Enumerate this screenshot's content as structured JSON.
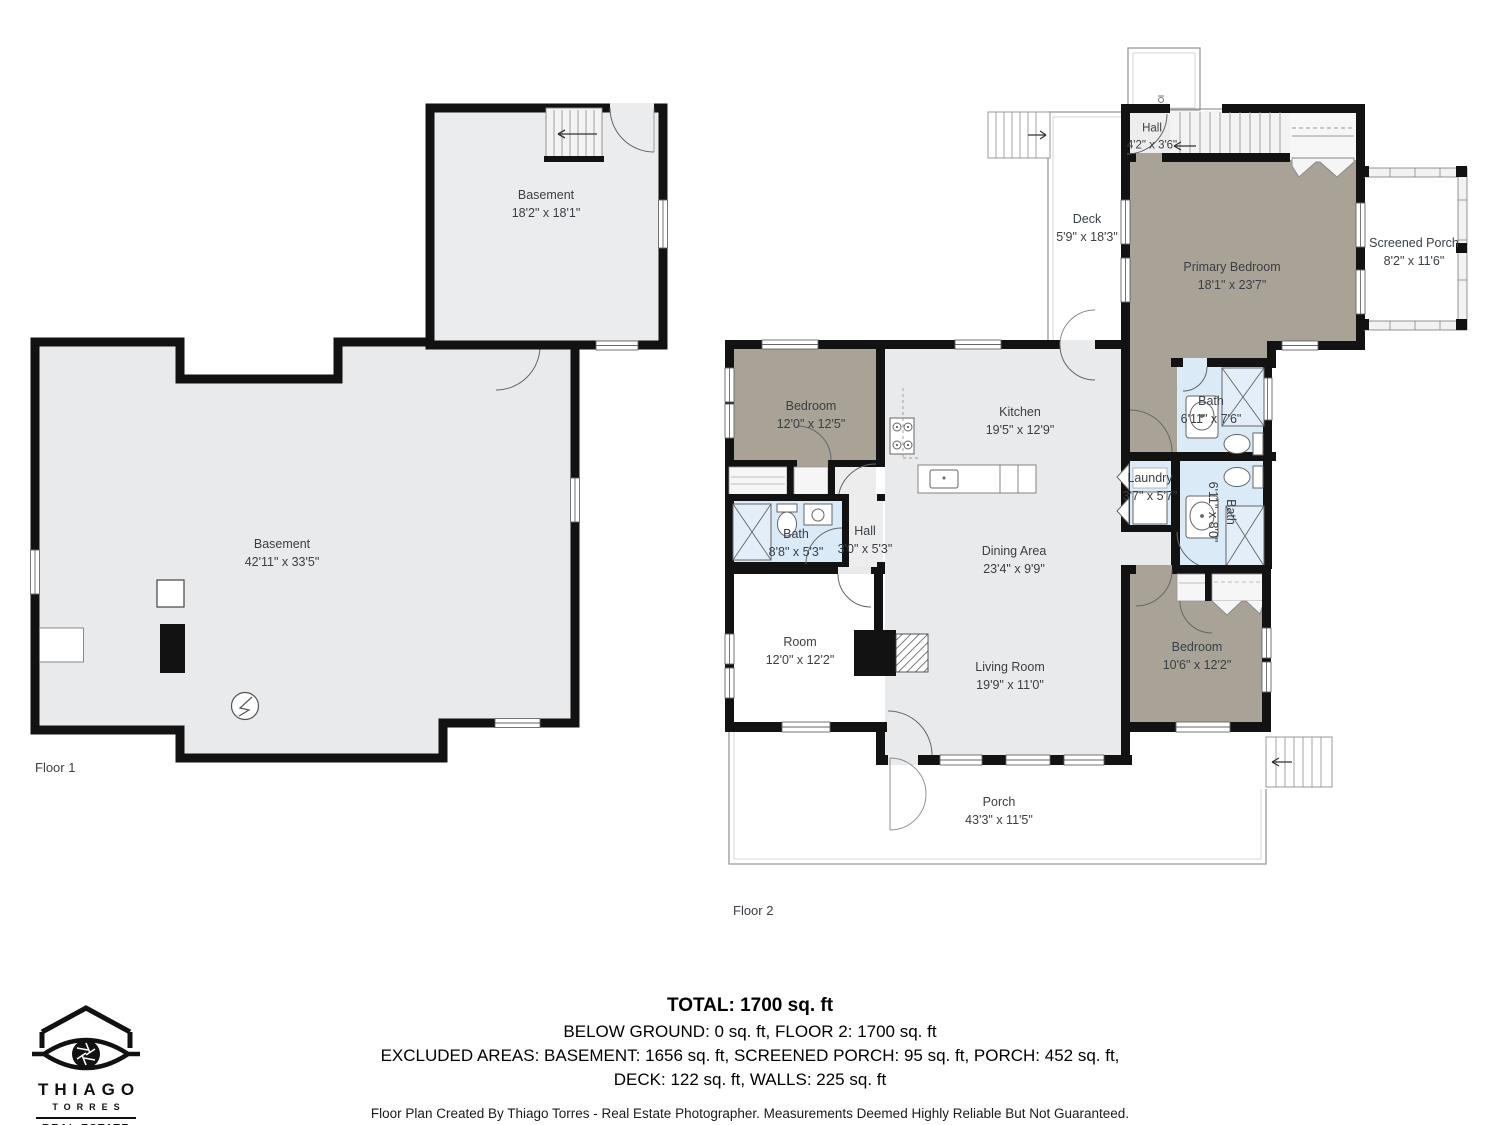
{
  "floor1": {
    "caption": "Floor 1",
    "rooms": {
      "basement_upper": {
        "name": "Basement",
        "dims": "18'2\" x 18'1\""
      },
      "basement_main": {
        "name": "Basement",
        "dims": "42'11\" x 33'5\""
      }
    }
  },
  "floor2": {
    "caption": "Floor 2",
    "rooms": {
      "hall_top": {
        "name": "Hall",
        "dims": "4'2\" x 3'6\""
      },
      "deck": {
        "name": "Deck",
        "dims": "5'9\" x 18'3\""
      },
      "primary_bedroom": {
        "name": "Primary Bedroom",
        "dims": "18'1\" x 23'7\""
      },
      "screened_porch": {
        "name": "Screened Porch",
        "dims": "8'2\" x 11'6\""
      },
      "bedroom_upper": {
        "name": "Bedroom",
        "dims": "12'0\" x 12'5\""
      },
      "kitchen": {
        "name": "Kitchen",
        "dims": "19'5\" x 12'9\""
      },
      "bath_main": {
        "name": "Bath",
        "dims": "8'8\" x 5'3\""
      },
      "hall_main": {
        "name": "Hall",
        "dims": "3'0\" x 5'3\""
      },
      "dining": {
        "name": "Dining Area",
        "dims": "23'4\" x 9'9\""
      },
      "room": {
        "name": "Room",
        "dims": "12'0\" x 12'2\""
      },
      "living": {
        "name": "Living Room",
        "dims": "19'9\" x 11'0\""
      },
      "laundry": {
        "name": "Laundry",
        "dims": "3'7\" x 5'7\""
      },
      "bath_upper": {
        "name": "Bath",
        "dims": "6'11\" x 7'6\""
      },
      "bath_lower": {
        "name": "Bath",
        "dims": "6'11\" x 8'0\""
      },
      "bedroom_lower": {
        "name": "Bedroom",
        "dims": "10'6\" x 12'2\""
      },
      "porch": {
        "name": "Porch",
        "dims": "43'3\" x 11'5\""
      }
    }
  },
  "summary": {
    "total": "TOTAL: 1700 sq. ft",
    "line2": "BELOW GROUND: 0 sq. ft, FLOOR 2: 1700 sq. ft",
    "line3": "EXCLUDED AREAS: BASEMENT: 1656 sq. ft, SCREENED PORCH: 95 sq. ft, PORCH: 452 sq. ft,",
    "line4": "DECK: 122 sq. ft, WALLS: 225 sq. ft",
    "disclaimer": "Floor Plan Created By Thiago Torres - Real Estate Photographer. Measurements Deemed Highly Reliable But Not Guaranteed."
  },
  "logo": {
    "name_top": "THIAGO",
    "name_bottom": "TORRES",
    "line1": "REAL ESTATE",
    "line2": "PHOTOGRAPHER"
  },
  "colors": {
    "wall": "#121212",
    "room_gray": "#e9eaec",
    "room_taupe": "#a9a296",
    "room_blue": "#dbeaf7",
    "thin_line": "#999999",
    "label_text": "#3a4045"
  }
}
